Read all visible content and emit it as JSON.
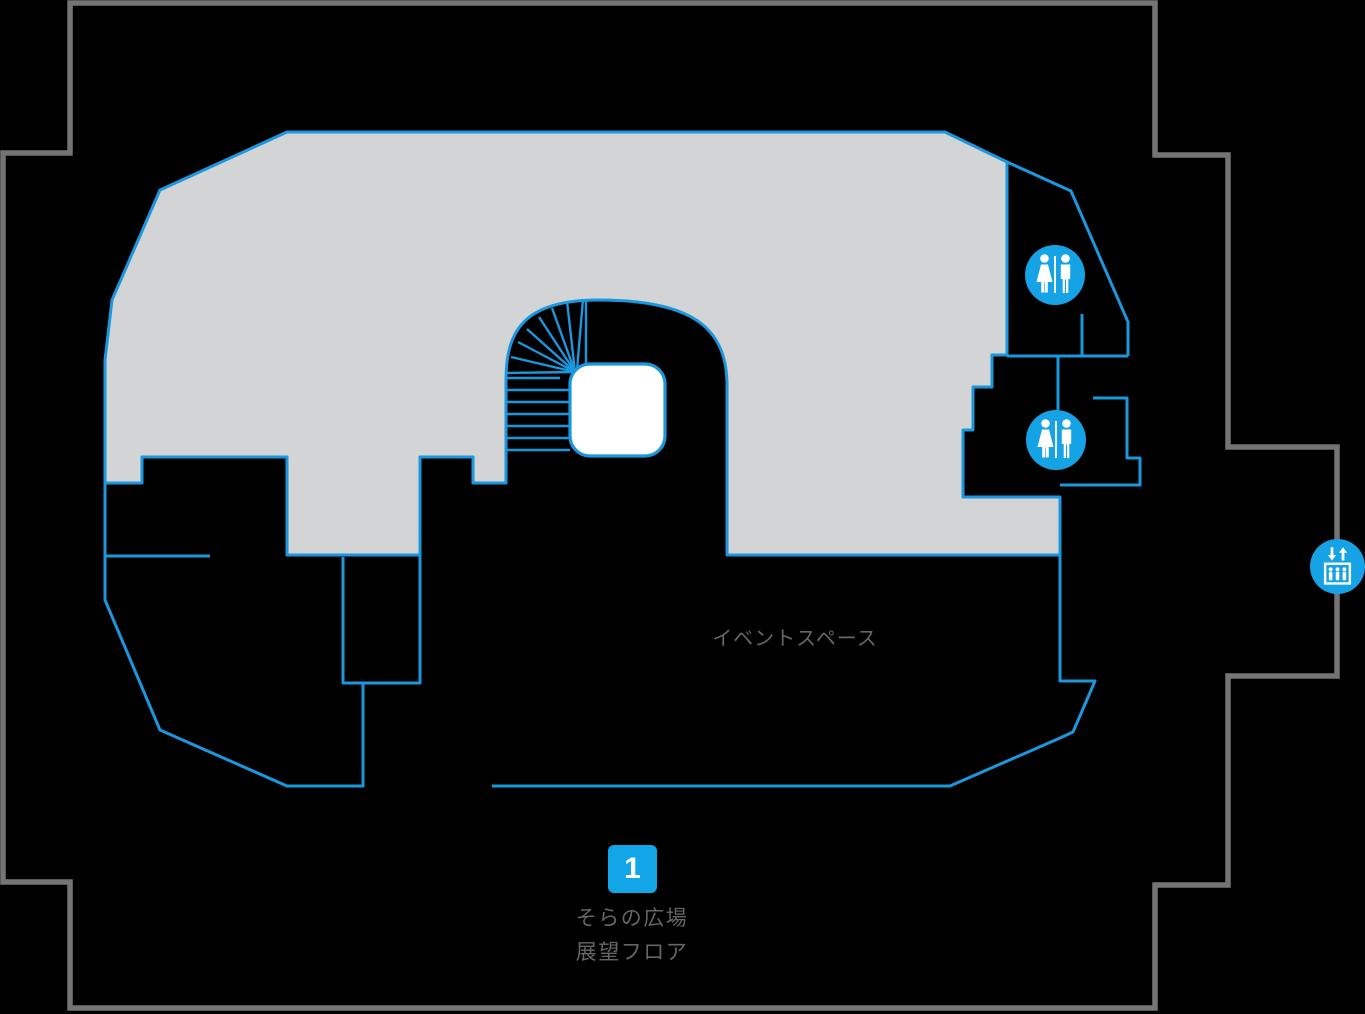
{
  "floor_map": {
    "title_area": {
      "marker_number": "1",
      "legend_line1": "そらの広場",
      "legend_line2": "展望フロア"
    },
    "labels": {
      "event_space": "イベントスペース"
    },
    "icons": [
      {
        "name": "restroom-icon",
        "location": "upper-right-room"
      },
      {
        "name": "restroom-icon",
        "location": "mid-right-room"
      },
      {
        "name": "elevator-icon",
        "location": "right-outer-wall"
      }
    ],
    "colors": {
      "bg": "#000000",
      "outline_gray": "#747474",
      "floor_fill": "#d3d4d5",
      "line_blue": "#1b97dd",
      "icon_blue": "#16a3e6",
      "marker_blue": "#12a6e9",
      "text_gray": "#666666",
      "core_white": "#ffffff"
    }
  }
}
